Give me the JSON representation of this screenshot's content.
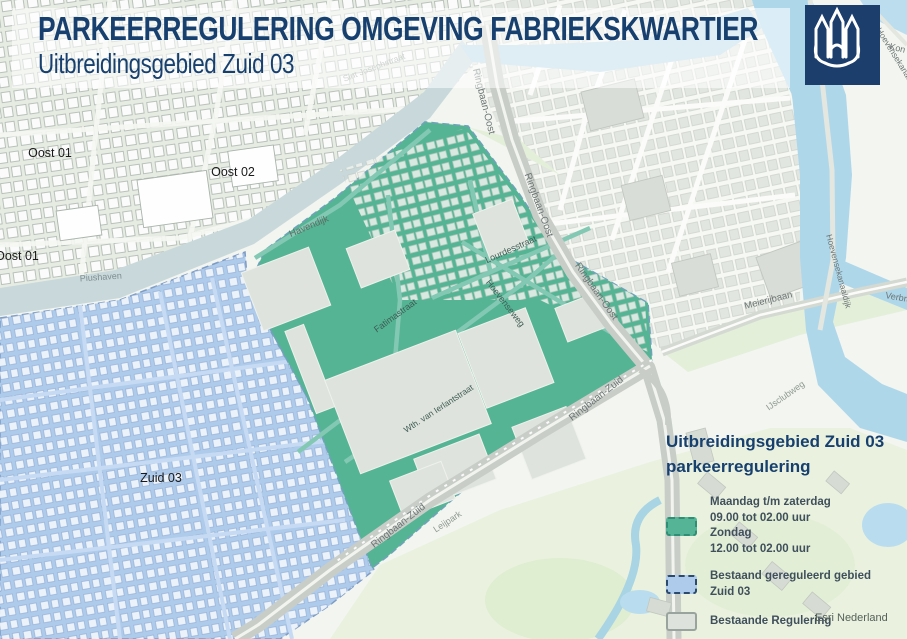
{
  "header": {
    "title": "PARKEERREGULERING OMGEVING FABRIEKSKWARTIER",
    "subtitle": "Uitbreidingsgebied Zuid 03"
  },
  "logo": {
    "name": "gemeente-tilburg-castle-logo",
    "background_color": "#1B3E6C",
    "glyph_color": "#FFFFFF"
  },
  "legend": {
    "title_line1": "Uitbreidingsgebied Zuid 03",
    "title_line2": "parkeerregulering",
    "items": [
      {
        "swatch_color": "#55B495",
        "border_style": "dashed",
        "border_color": "#2F8E74",
        "lines": [
          "Maandag t/m zaterdag",
          "09.00 tot 02.00 uur",
          "Zondag",
          "12.00 tot 02.00 uur"
        ]
      },
      {
        "swatch_color": "#AECBEC",
        "border_style": "dashed",
        "border_color": "#2C4A6E",
        "lines": [
          "Bestaand gereguleerd gebied",
          "Zuid 03"
        ]
      },
      {
        "swatch_color": "#DDE3DC",
        "border_style": "solid",
        "border_color": "#9AA49E",
        "lines": [
          "Bestaande Regulering"
        ]
      }
    ]
  },
  "attribution": "Esri Nederland",
  "map": {
    "colors": {
      "new_regulation_area": "#54B494",
      "existing_regulated_area": "#AECBEC",
      "canal_water": "#AFD7EA",
      "harbour_water": "#C9D9DB",
      "park_green": "#EAF2DF",
      "road_gray": "#C8CDC8",
      "title_navy": "#17406F"
    },
    "area_labels": [
      {
        "text": "Oost 01"
      },
      {
        "text": "Oost 02"
      },
      {
        "text": "Oost 01"
      },
      {
        "text": "Zuid 03"
      }
    ],
    "street_labels": [
      {
        "text": "Sint Josephstraat"
      },
      {
        "text": "Havendijk"
      },
      {
        "text": "Ringbaan-Oost"
      },
      {
        "text": "Ringbaan-Oost"
      },
      {
        "text": "Ringbaan-Oost"
      },
      {
        "text": "Lourdesstraat"
      },
      {
        "text": "Hoevenseweg"
      },
      {
        "text": "Fatimastraat"
      },
      {
        "text": "Wth. van Ierlantstraat"
      },
      {
        "text": "Ringbaan-Zuid"
      },
      {
        "text": "Ringbaan-Zuid"
      },
      {
        "text": "Leijpark"
      },
      {
        "text": "Meierijbaan"
      },
      {
        "text": "Hoevensekanaaldijk"
      },
      {
        "text": "Hoevensekanaaldijk"
      },
      {
        "text": "Kon"
      },
      {
        "text": "Verbra"
      },
      {
        "text": "IJsclubweg"
      },
      {
        "text": "Piushaven"
      }
    ]
  }
}
